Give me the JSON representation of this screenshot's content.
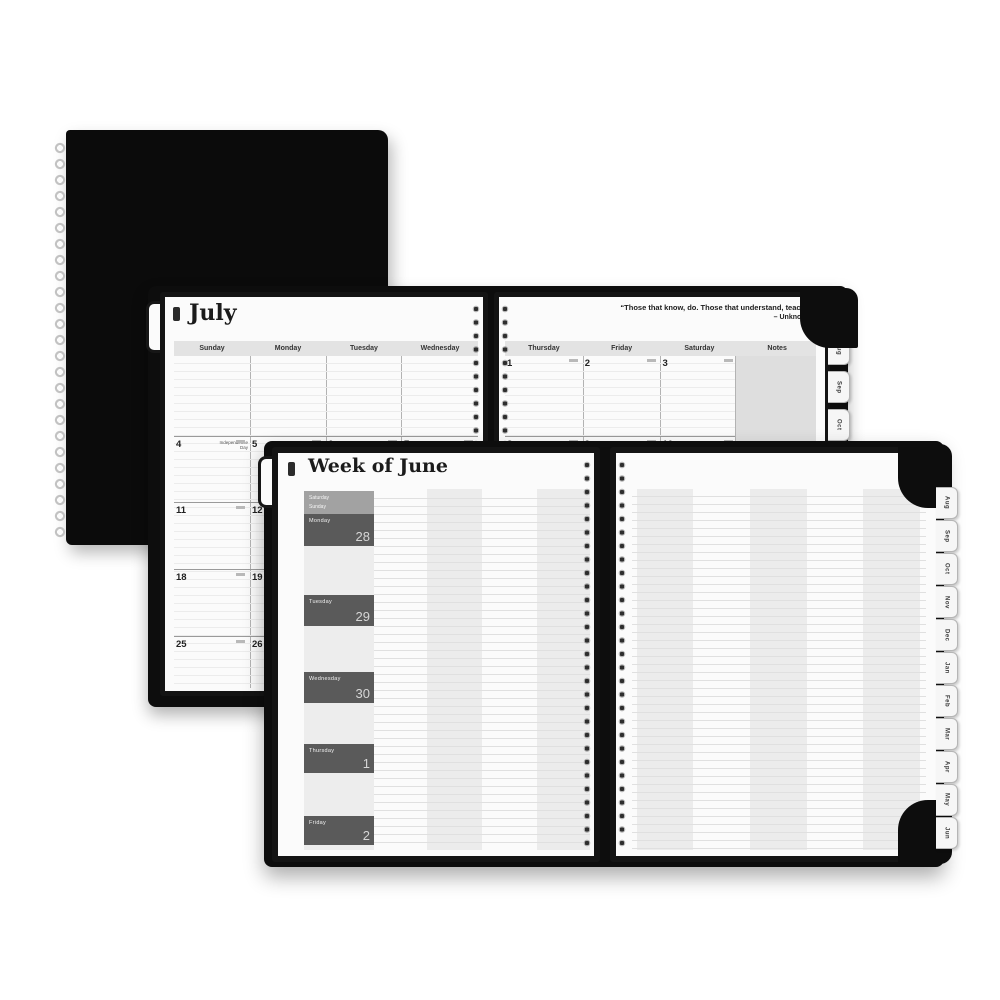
{
  "photo": {
    "background": "#ffffff"
  },
  "colors": {
    "cover": "#0d0d0d",
    "page": "#fbfbfb",
    "header_band": "#e3e3e3",
    "column_stripe": "#ececec",
    "day_block_dark": "#5a5a5a",
    "day_block_light": "#a2a2a2",
    "notes_column": "#dedede"
  },
  "monthly": {
    "title": "July",
    "quote": "“Those that know, do. Those that understand, teach.”",
    "quote_attribution": "– Unknown",
    "left_day_headers": [
      "Sunday",
      "Monday",
      "Tuesday",
      "Wednesday"
    ],
    "right_day_headers": [
      "Thursday",
      "Friday",
      "Saturday",
      "Notes"
    ],
    "left_rows": {
      "r1": [
        "4",
        "5",
        "6",
        "7"
      ],
      "r2": [
        "11",
        "12"
      ],
      "r3": [
        "18",
        "19"
      ],
      "r4": [
        "25",
        "26"
      ]
    },
    "right_rows": {
      "r1": [
        "1",
        "2",
        "3"
      ],
      "r2": [
        "8",
        "9",
        "10"
      ]
    },
    "holiday_note": "Independence Day",
    "tabs": [
      "Aug",
      "Sep",
      "Oct"
    ]
  },
  "weekly": {
    "title": "Week of June",
    "weekend_block": {
      "top": "Saturday",
      "bottom": "Sunday"
    },
    "day_blocks": [
      {
        "label": "Monday",
        "date": "28"
      },
      {
        "label": "Tuesday",
        "date": "29"
      },
      {
        "label": "Wednesday",
        "date": "30"
      },
      {
        "label": "Thursday",
        "date": "1"
      },
      {
        "label": "Friday",
        "date": "2"
      }
    ],
    "tabs": [
      "Aug",
      "Sep",
      "Oct",
      "Nov",
      "Dec",
      "Jan",
      "Feb",
      "Mar",
      "Apr",
      "May",
      "Jun"
    ]
  }
}
